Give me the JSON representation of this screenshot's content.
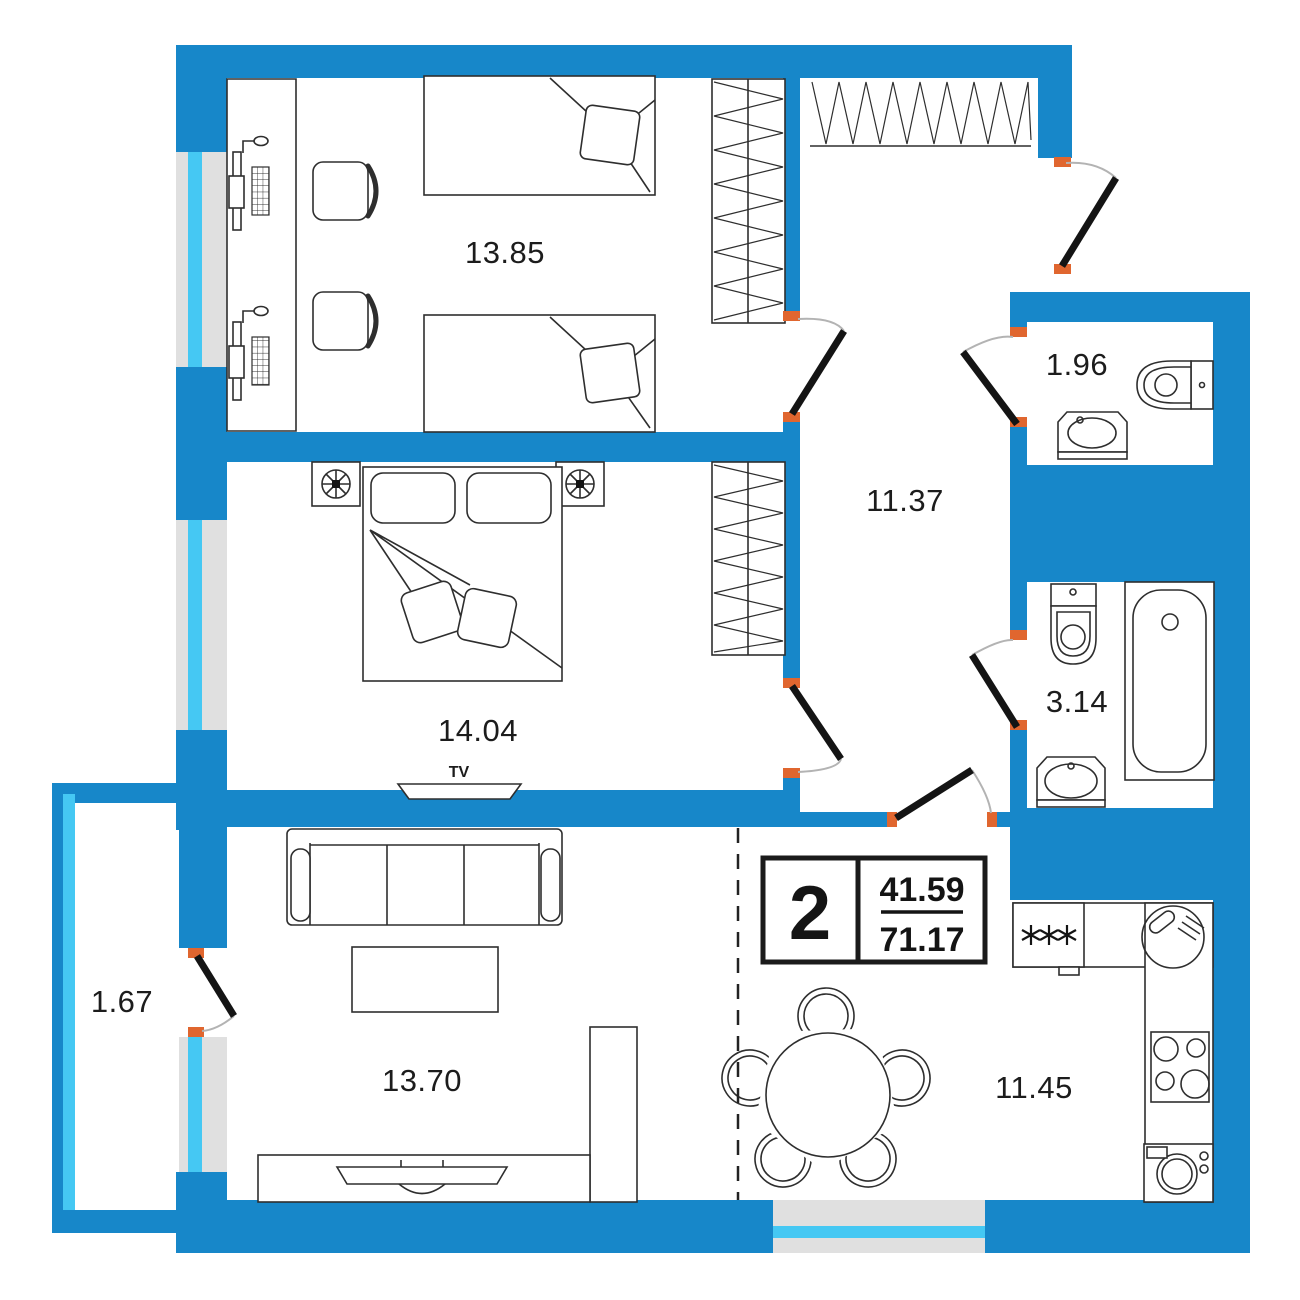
{
  "rooms": [
    {
      "name": "bedroom-1",
      "area": "13.85"
    },
    {
      "name": "bedroom-2",
      "area": "14.04"
    },
    {
      "name": "hallway",
      "area": "11.37"
    },
    {
      "name": "wc",
      "area": "1.96"
    },
    {
      "name": "bathroom",
      "area": "3.14"
    },
    {
      "name": "balcony",
      "area": "1.67"
    },
    {
      "name": "living-room",
      "area": "13.70"
    },
    {
      "name": "kitchen-dining",
      "area": "11.45"
    }
  ],
  "labels": {
    "tv": "TV"
  },
  "badge": {
    "rooms_count": "2",
    "area_living": "41.59",
    "area_total": "71.17"
  },
  "colors": {
    "wall": "#1787c9",
    "glass": "#45c8f3",
    "window_band": "#e0e0e0",
    "door_marker": "#e0662f",
    "door_leaf": "#141414"
  }
}
